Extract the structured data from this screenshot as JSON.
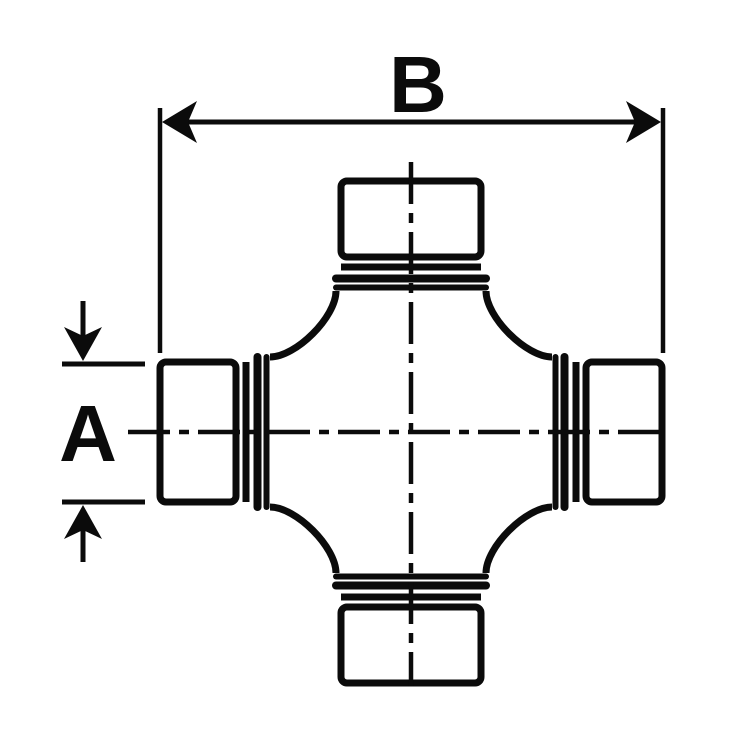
{
  "diagram": {
    "type": "technical-drawing",
    "subject": "universal-joint-cross",
    "background_color": "#ffffff",
    "line_color": "#0b0b0b",
    "dimensions": {
      "overall_width_label": "B",
      "cap_diameter_label": "A"
    }
  }
}
